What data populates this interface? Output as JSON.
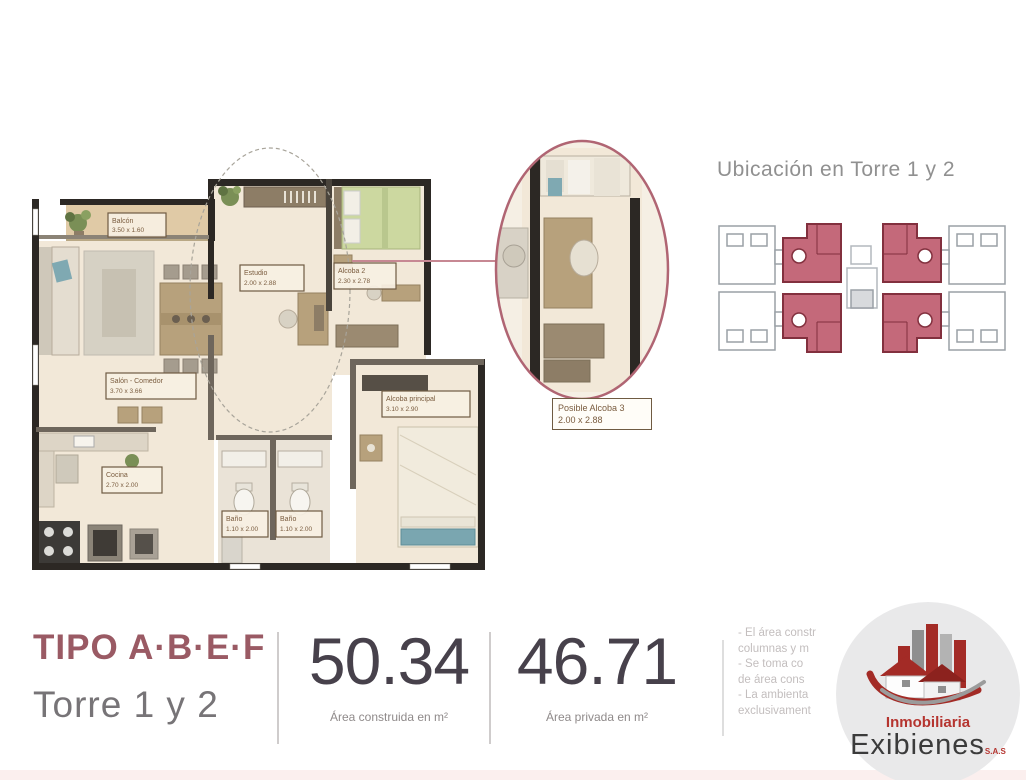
{
  "colors": {
    "accent_maroon": "#9a5a64",
    "keyplan_red": "#c4697a",
    "keyplan_red_dark": "#82303e",
    "callout_ring": "#b06573",
    "wall_dark": "#2c2824",
    "floor_cream": "#f2e8d8",
    "balcony_tan": "#e0caa6",
    "number_dark": "#47414b",
    "logo_red": "#b5342f"
  },
  "floorplan": {
    "rooms": [
      {
        "name": "Balcón",
        "dims": "3.50 x 1.60"
      },
      {
        "name": "Salón - Comedor",
        "dims": "3.70 x 3.66"
      },
      {
        "name": "Estudio",
        "dims": "2.00 x 2.88"
      },
      {
        "name": "Alcoba 2",
        "dims": "2.30 x 2.78"
      },
      {
        "name": "Alcoba principal",
        "dims": "3.10 x 2.90"
      },
      {
        "name": "Cocina",
        "dims": "2.70 x 2.00"
      },
      {
        "name": "Baño",
        "dims": "1.10 x 2.00"
      },
      {
        "name": "Baño",
        "dims": "1.10 x 2.00"
      }
    ],
    "callout": {
      "name": "Posible Alcoba 3",
      "dims": "2.00 x 2.88"
    }
  },
  "location": {
    "title": "Ubicación en Torre 1 y 2"
  },
  "summary": {
    "type_label": "TIPO A·B·E·F",
    "tower_label": "Torre 1 y 2",
    "built_area_value": "50.34",
    "built_area_caption": "Área construida en m²",
    "private_area_value": "46.71",
    "private_area_caption": "Área privada en m²",
    "notes_lines": [
      "- El área constr",
      "columnas y m",
      "- Se toma co",
      "de área cons",
      "- La ambienta",
      "exclusivament"
    ]
  },
  "logo": {
    "brand_top": "Inmobiliaria",
    "brand_main": "Exibienes",
    "brand_suffix": "S.A.S"
  }
}
